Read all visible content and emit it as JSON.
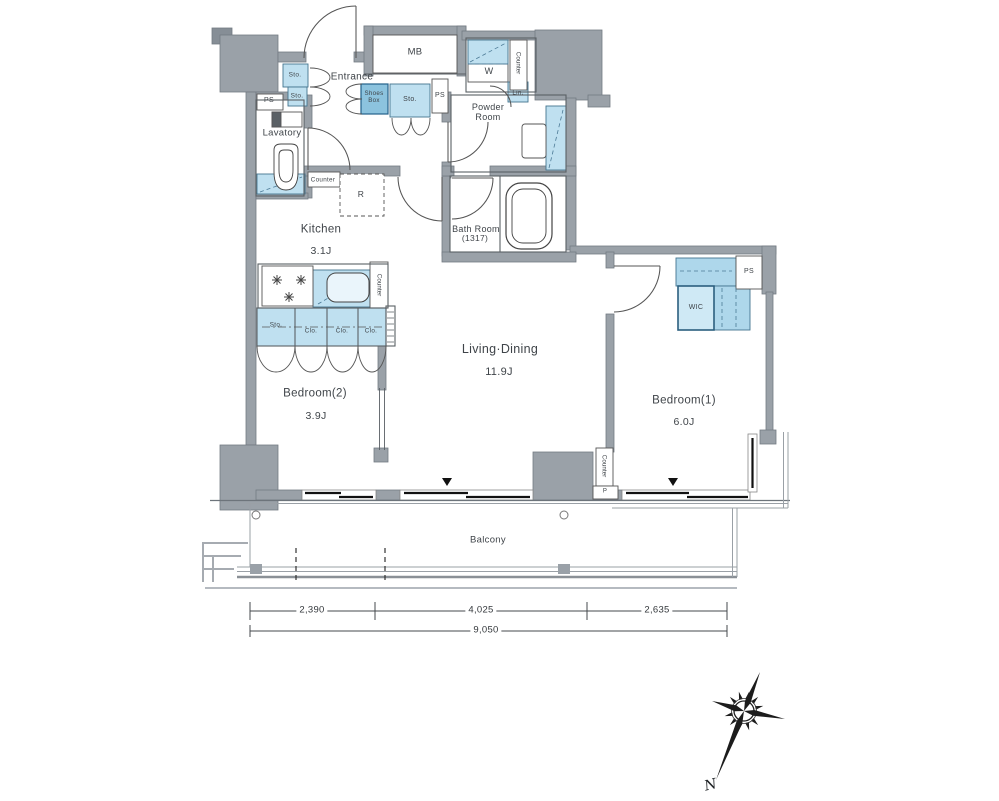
{
  "rooms": {
    "entrance": "Entrance",
    "lavatory": "Lavatory",
    "powder_room": "Powder Room",
    "kitchen": "Kitchen",
    "kitchen_size": "3.1J",
    "bath_room": "Bath Room",
    "bath_size": "(1317)",
    "living_dining": "Living·Dining",
    "living_size": "11.9J",
    "bedroom1": "Bedroom(1)",
    "bedroom1_size": "6.0J",
    "bedroom2": "Bedroom(2)",
    "bedroom2_size": "3.9J",
    "balcony": "Balcony",
    "wic": "WIC"
  },
  "fixtures": {
    "meter_box": "MB",
    "washer": "W",
    "linen": "Lin.",
    "shoes_box": "Shoes Box",
    "storage": "Sto.",
    "closet": "Clo.",
    "counter": "Counter",
    "refrigerator": "R",
    "pipe_space": "PS",
    "pillar": "P"
  },
  "dimensions": {
    "seg1": "2,390",
    "seg2": "4,025",
    "seg3": "2,635",
    "total": "9,050"
  },
  "compass": {
    "north": "N"
  },
  "colors": {
    "wall_gray": "#9aa1a8",
    "fixture_blue": "#bfe0f0",
    "fixture_blue_dark": "#8cc3de",
    "wic_blue": "#cfe9f5",
    "line": "#555555"
  }
}
